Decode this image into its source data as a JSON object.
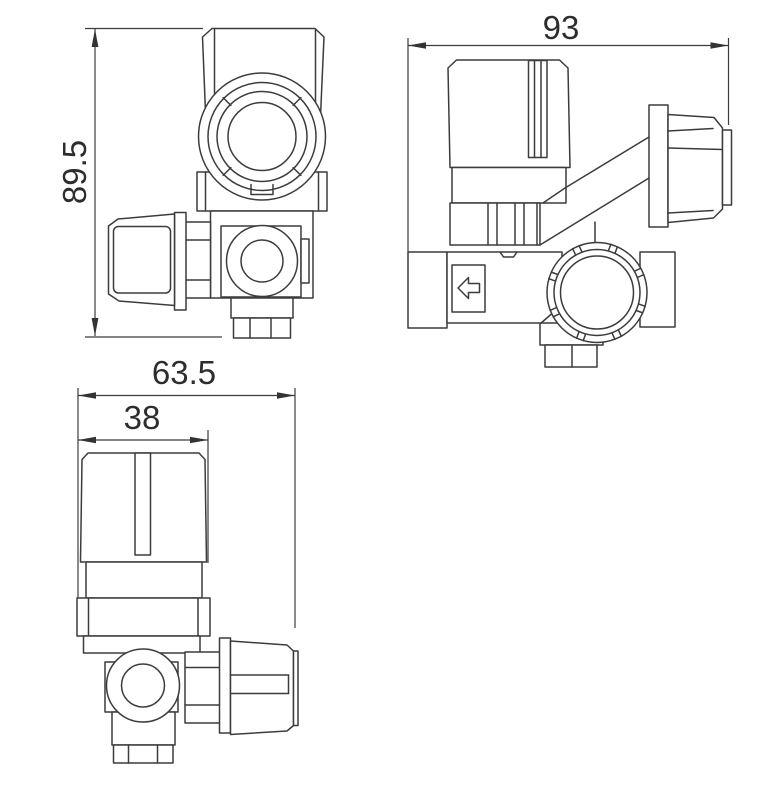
{
  "colors": {
    "background": "#ffffff",
    "line": "#3c3c3c",
    "text": "#2d2d2d"
  },
  "views": {
    "front": {
      "height_label": "89.5"
    },
    "side": {
      "width_label": "93",
      "flow_arrow_icon": "arrow-left"
    },
    "bottom": {
      "overall_width_label": "63.5",
      "knob_width_label": "38"
    }
  }
}
